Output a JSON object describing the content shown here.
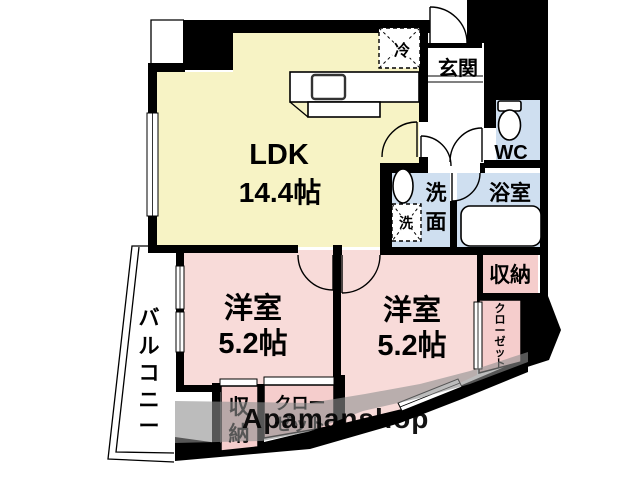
{
  "floorplan": {
    "ldk": {
      "name": "LDK",
      "size": "14.4帖"
    },
    "room_left": {
      "name": "洋室",
      "size": "5.2帖"
    },
    "room_right": {
      "name": "洋室",
      "size": "5.2帖"
    },
    "entrance": "玄関",
    "meter_box": {
      "chars": [
        "M",
        "B"
      ]
    },
    "wc": "WC",
    "bath": "浴室",
    "washroom": {
      "chars": [
        "洗",
        "面"
      ]
    },
    "washer": "洗",
    "fridge": "冷",
    "storage_right": "収納",
    "closet_right": {
      "chars": [
        "ク",
        "ロ",
        "ー",
        "ゼ",
        "ッ",
        "ト"
      ]
    },
    "storage_bottom": {
      "chars": [
        "収",
        "納"
      ]
    },
    "closet_bottom": {
      "line1": "クロー",
      "line2": "ゼット"
    },
    "balcony": {
      "chars": [
        "バ",
        "ル",
        "コ",
        "ニ",
        "ー"
      ]
    },
    "watermark": "Apamanshop",
    "colors": {
      "ldk": "#f7f3c5",
      "room": "#f8dbd9",
      "storage": "#f5cdcc",
      "wet": "#cfdff0",
      "wall": "#000000",
      "watermark_band": "#909090",
      "watermark_text": "#595959"
    }
  }
}
